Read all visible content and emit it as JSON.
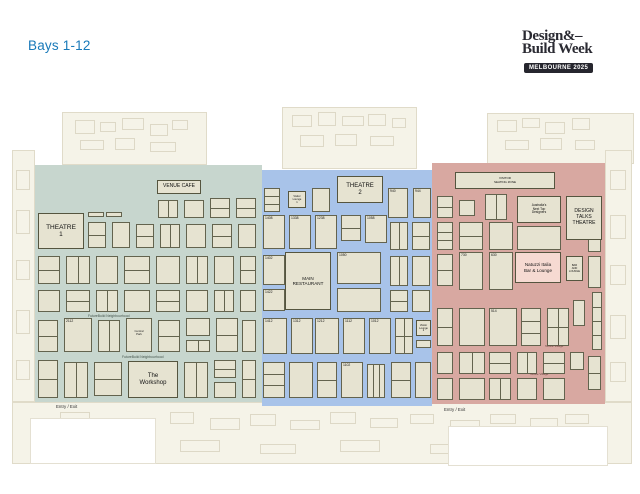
{
  "page": {
    "title": "Bays 1-12",
    "title_color": "#1879b9"
  },
  "logo": {
    "line1": "Design&–",
    "line2": "Build Week",
    "badge": "MELBOURNE 2025"
  },
  "colors": {
    "zone_green": "#c7d6ce",
    "zone_blue": "#a8c3e9",
    "zone_red": "#d8a8a1",
    "booth_fill": "#e6e3d1",
    "booth_border": "#63634e",
    "natuzzi_fill": "#f6dad2",
    "floor_cream": "#f5f3e8",
    "title_blue": "#1879b9"
  },
  "zones": [
    {
      "id": "zone-green",
      "x": 35,
      "y": 165,
      "w": 227,
      "h": 237,
      "color": "#c7d6ce"
    },
    {
      "id": "zone-blue",
      "x": 262,
      "y": 170,
      "w": 170,
      "h": 236,
      "color": "#a8c3e9"
    },
    {
      "id": "zone-red",
      "x": 432,
      "y": 163,
      "w": 173,
      "h": 241,
      "color": "#d8a8a1"
    }
  ],
  "venues": [
    {
      "id": "theatre-1",
      "x": 38,
      "y": 213,
      "w": 46,
      "h": 36,
      "label": "THEATRE\n1",
      "fs": 6.5
    },
    {
      "id": "venue-cafe",
      "x": 157,
      "y": 180,
      "w": 44,
      "h": 14,
      "label": "VENUE CAFE",
      "fs": 5
    },
    {
      "id": "theatre-2",
      "x": 337,
      "y": 176,
      "w": 46,
      "h": 27,
      "label": "THEATRE\n2",
      "fs": 6
    },
    {
      "id": "main-restaurant",
      "x": 285,
      "y": 252,
      "w": 46,
      "h": 58,
      "label": "MAIN\nRESTAURANT",
      "fs": 4.6
    },
    {
      "id": "the-workshop",
      "x": 128,
      "y": 361,
      "w": 50,
      "h": 37,
      "label": "The\nWorkshop",
      "fs": 6
    },
    {
      "id": "visitor-seating-zone",
      "x": 455,
      "y": 172,
      "w": 100,
      "h": 17,
      "label": "VISITOR\nSEATING ZONE",
      "fs": 3
    },
    {
      "id": "next-top-designers",
      "x": 517,
      "y": 196,
      "w": 44,
      "h": 27,
      "label": "Australia's\nNext Top\nDesigners",
      "fs": 3.2
    },
    {
      "id": "design-talks-theatre",
      "x": 566,
      "y": 196,
      "w": 36,
      "h": 44,
      "label": "DESIGN\nTALKS\nTHEATRE",
      "fs": 5
    },
    {
      "id": "natuzzi-bar-lounge",
      "x": 515,
      "y": 252,
      "w": 46,
      "h": 31,
      "label": "Natuzzi Italia\nBar & Lounge",
      "fs": 4.6,
      "fill": "#f6dad2"
    },
    {
      "id": "bar-and-lounge",
      "x": 566,
      "y": 256,
      "w": 17,
      "h": 25,
      "label": "BAR\nAND\nLOUNGE",
      "fs": 2.6
    },
    {
      "id": "visitor-lounge-1",
      "x": 288,
      "y": 191,
      "w": 18,
      "h": 17,
      "label": "Visitor\nLounge\n1",
      "fs": 2.6
    },
    {
      "id": "visitor-lounge-2",
      "x": 416,
      "y": 320,
      "w": 15,
      "h": 16,
      "label": "Visitor\nLounge\n2",
      "fs": 2.6
    }
  ],
  "small_labels": [
    {
      "id": "futurebuild-label-1",
      "text": "FutureBuild Neighbourhood",
      "x": 88,
      "y": 314,
      "fs": 3.4,
      "color": "#44544c"
    },
    {
      "id": "futurebuild-label-2",
      "text": "FutureBuild Neighbourhood",
      "x": 122,
      "y": 355,
      "fs": 3.4,
      "color": "#44544c"
    },
    {
      "id": "textile-village-label-1",
      "text": "Textile Village",
      "x": 545,
      "y": 344,
      "fs": 3,
      "color": "#6a4540"
    },
    {
      "id": "textile-village-label-2",
      "text": "Textile Village",
      "x": 530,
      "y": 372,
      "fs": 3,
      "color": "#6a4540"
    },
    {
      "id": "entry-exit-label-left",
      "text": "Entry / Exit",
      "x": 56,
      "y": 404,
      "fs": 4.4,
      "color": "#333333"
    },
    {
      "id": "entry-exit-label-right",
      "text": "Entry / Exit",
      "x": 444,
      "y": 407,
      "fs": 4.4,
      "color": "#333333"
    }
  ],
  "booths": {
    "green": [
      {
        "x": 88,
        "y": 212,
        "w": 16,
        "h": 5
      },
      {
        "x": 106,
        "y": 212,
        "w": 16,
        "h": 5
      },
      {
        "x": 158,
        "y": 200,
        "w": 20,
        "h": 18,
        "d": "v"
      },
      {
        "x": 184,
        "y": 200,
        "w": 20,
        "h": 18
      },
      {
        "x": 210,
        "y": 198,
        "w": 20,
        "h": 20,
        "d": "h"
      },
      {
        "x": 236,
        "y": 198,
        "w": 20,
        "h": 20,
        "d": "h"
      },
      {
        "x": 88,
        "y": 222,
        "w": 18,
        "h": 26,
        "d": "h"
      },
      {
        "x": 112,
        "y": 222,
        "w": 18,
        "h": 26
      },
      {
        "x": 136,
        "y": 224,
        "w": 18,
        "h": 24,
        "d": "h"
      },
      {
        "x": 160,
        "y": 224,
        "w": 20,
        "h": 24,
        "d": "v"
      },
      {
        "x": 186,
        "y": 224,
        "w": 20,
        "h": 24
      },
      {
        "x": 212,
        "y": 224,
        "w": 20,
        "h": 24,
        "d": "h"
      },
      {
        "x": 238,
        "y": 224,
        "w": 18,
        "h": 24
      },
      {
        "x": 38,
        "y": 256,
        "w": 22,
        "h": 28,
        "d": "h"
      },
      {
        "x": 66,
        "y": 256,
        "w": 24,
        "h": 28,
        "d": "v"
      },
      {
        "x": 96,
        "y": 256,
        "w": 22,
        "h": 28
      },
      {
        "x": 124,
        "y": 256,
        "w": 26,
        "h": 28,
        "d": "h"
      },
      {
        "x": 156,
        "y": 256,
        "w": 24,
        "h": 28
      },
      {
        "x": 186,
        "y": 256,
        "w": 22,
        "h": 28,
        "d": "v"
      },
      {
        "x": 214,
        "y": 256,
        "w": 20,
        "h": 28
      },
      {
        "x": 240,
        "y": 256,
        "w": 16,
        "h": 28,
        "d": "h"
      },
      {
        "x": 38,
        "y": 290,
        "w": 22,
        "h": 22
      },
      {
        "x": 66,
        "y": 290,
        "w": 24,
        "h": 22,
        "d": "h"
      },
      {
        "x": 96,
        "y": 290,
        "w": 22,
        "h": 22,
        "d": "v"
      },
      {
        "x": 124,
        "y": 290,
        "w": 26,
        "h": 22
      },
      {
        "x": 156,
        "y": 290,
        "w": 24,
        "h": 22,
        "d": "h"
      },
      {
        "x": 186,
        "y": 290,
        "w": 22,
        "h": 22
      },
      {
        "x": 214,
        "y": 290,
        "w": 20,
        "h": 22,
        "d": "v"
      },
      {
        "x": 240,
        "y": 290,
        "w": 16,
        "h": 22
      },
      {
        "x": 38,
        "y": 320,
        "w": 20,
        "h": 32,
        "d": "h"
      },
      {
        "x": 64,
        "y": 318,
        "w": 28,
        "h": 34,
        "n": "2112"
      },
      {
        "x": 98,
        "y": 320,
        "w": 22,
        "h": 32,
        "d": "v"
      },
      {
        "x": 126,
        "y": 318,
        "w": 26,
        "h": 34,
        "t": "Central\nPark"
      },
      {
        "x": 158,
        "y": 320,
        "w": 22,
        "h": 32,
        "d": "h"
      },
      {
        "x": 186,
        "y": 318,
        "w": 24,
        "h": 18
      },
      {
        "x": 186,
        "y": 340,
        "w": 24,
        "h": 12,
        "d": "v"
      },
      {
        "x": 216,
        "y": 318,
        "w": 22,
        "h": 34,
        "d": "h"
      },
      {
        "x": 242,
        "y": 320,
        "w": 14,
        "h": 32
      },
      {
        "x": 38,
        "y": 360,
        "w": 20,
        "h": 38,
        "d": "h"
      },
      {
        "x": 64,
        "y": 362,
        "w": 24,
        "h": 36,
        "d": "v"
      },
      {
        "x": 94,
        "y": 362,
        "w": 28,
        "h": 34,
        "d": "h"
      },
      {
        "x": 184,
        "y": 362,
        "w": 24,
        "h": 36,
        "d": "v"
      },
      {
        "x": 214,
        "y": 360,
        "w": 22,
        "h": 18,
        "d": "h"
      },
      {
        "x": 214,
        "y": 382,
        "w": 22,
        "h": 16
      },
      {
        "x": 242,
        "y": 360,
        "w": 14,
        "h": 38,
        "d": "h"
      }
    ],
    "blue": [
      {
        "x": 264,
        "y": 188,
        "w": 16,
        "h": 24,
        "d": "h2"
      },
      {
        "x": 312,
        "y": 188,
        "w": 18,
        "h": 24
      },
      {
        "x": 388,
        "y": 188,
        "w": 20,
        "h": 30,
        "n": "940"
      },
      {
        "x": 413,
        "y": 188,
        "w": 18,
        "h": 30,
        "n": "944"
      },
      {
        "x": 263,
        "y": 215,
        "w": 22,
        "h": 34,
        "n": "1408"
      },
      {
        "x": 289,
        "y": 215,
        "w": 22,
        "h": 34,
        "n": "1338"
      },
      {
        "x": 315,
        "y": 215,
        "w": 22,
        "h": 34,
        "n": "1238"
      },
      {
        "x": 341,
        "y": 215,
        "w": 20,
        "h": 26,
        "d": "h"
      },
      {
        "x": 365,
        "y": 215,
        "w": 22,
        "h": 28,
        "n": "1058"
      },
      {
        "x": 390,
        "y": 222,
        "w": 18,
        "h": 28,
        "d": "v"
      },
      {
        "x": 412,
        "y": 222,
        "w": 18,
        "h": 28,
        "d": "h"
      },
      {
        "x": 263,
        "y": 255,
        "w": 22,
        "h": 30,
        "n": "1402"
      },
      {
        "x": 337,
        "y": 252,
        "w": 44,
        "h": 32,
        "n": "1050"
      },
      {
        "x": 390,
        "y": 256,
        "w": 18,
        "h": 30,
        "d": "v"
      },
      {
        "x": 412,
        "y": 256,
        "w": 18,
        "h": 30
      },
      {
        "x": 263,
        "y": 289,
        "w": 22,
        "h": 22,
        "n": "1422"
      },
      {
        "x": 337,
        "y": 288,
        "w": 44,
        "h": 24
      },
      {
        "x": 390,
        "y": 290,
        "w": 18,
        "h": 22,
        "d": "h"
      },
      {
        "x": 412,
        "y": 290,
        "w": 18,
        "h": 22
      },
      {
        "x": 263,
        "y": 318,
        "w": 24,
        "h": 36,
        "n": "1412"
      },
      {
        "x": 291,
        "y": 318,
        "w": 22,
        "h": 36,
        "n": "1312"
      },
      {
        "x": 315,
        "y": 318,
        "w": 24,
        "h": 36,
        "n": "1212"
      },
      {
        "x": 343,
        "y": 318,
        "w": 22,
        "h": 36,
        "n": "1112"
      },
      {
        "x": 369,
        "y": 318,
        "w": 22,
        "h": 36,
        "n": "1012"
      },
      {
        "x": 395,
        "y": 318,
        "w": 18,
        "h": 36,
        "d": "grid"
      },
      {
        "x": 416,
        "y": 340,
        "w": 15,
        "h": 8
      },
      {
        "x": 263,
        "y": 362,
        "w": 22,
        "h": 36,
        "d": "h2"
      },
      {
        "x": 289,
        "y": 362,
        "w": 24,
        "h": 36
      },
      {
        "x": 317,
        "y": 362,
        "w": 20,
        "h": 36,
        "d": "h"
      },
      {
        "x": 341,
        "y": 362,
        "w": 22,
        "h": 36,
        "n": "1102"
      },
      {
        "x": 367,
        "y": 364,
        "w": 18,
        "h": 34,
        "d": "v2"
      },
      {
        "x": 391,
        "y": 362,
        "w": 20,
        "h": 36,
        "d": "h"
      },
      {
        "x": 415,
        "y": 362,
        "w": 16,
        "h": 36
      }
    ],
    "red": [
      {
        "x": 437,
        "y": 196,
        "w": 16,
        "h": 22,
        "d": "h"
      },
      {
        "x": 459,
        "y": 200,
        "w": 16,
        "h": 16
      },
      {
        "x": 485,
        "y": 194,
        "w": 22,
        "h": 26,
        "d": "v"
      },
      {
        "x": 437,
        "y": 222,
        "w": 16,
        "h": 28,
        "d": "h2"
      },
      {
        "x": 459,
        "y": 222,
        "w": 24,
        "h": 28,
        "d": "h"
      },
      {
        "x": 489,
        "y": 222,
        "w": 24,
        "h": 28
      },
      {
        "x": 517,
        "y": 226,
        "w": 44,
        "h": 24
      },
      {
        "x": 437,
        "y": 254,
        "w": 16,
        "h": 32,
        "d": "h"
      },
      {
        "x": 459,
        "y": 252,
        "w": 24,
        "h": 38,
        "n": "730"
      },
      {
        "x": 489,
        "y": 252,
        "w": 24,
        "h": 38,
        "n": "630"
      },
      {
        "x": 588,
        "y": 224,
        "w": 13,
        "h": 28,
        "d": "h"
      },
      {
        "x": 588,
        "y": 256,
        "w": 13,
        "h": 32
      },
      {
        "x": 437,
        "y": 308,
        "w": 16,
        "h": 38,
        "d": "h"
      },
      {
        "x": 459,
        "y": 308,
        "w": 26,
        "h": 38
      },
      {
        "x": 489,
        "y": 308,
        "w": 28,
        "h": 38,
        "n": "514"
      },
      {
        "x": 521,
        "y": 308,
        "w": 20,
        "h": 38,
        "d": "h2"
      },
      {
        "x": 547,
        "y": 308,
        "w": 22,
        "h": 38,
        "d": "grid"
      },
      {
        "x": 573,
        "y": 300,
        "w": 12,
        "h": 26
      },
      {
        "x": 592,
        "y": 292,
        "w": 10,
        "h": 58,
        "d": "h3"
      },
      {
        "x": 437,
        "y": 352,
        "w": 16,
        "h": 22
      },
      {
        "x": 459,
        "y": 352,
        "w": 26,
        "h": 22,
        "d": "v"
      },
      {
        "x": 489,
        "y": 352,
        "w": 22,
        "h": 22,
        "d": "h"
      },
      {
        "x": 517,
        "y": 352,
        "w": 20,
        "h": 22,
        "d": "v"
      },
      {
        "x": 543,
        "y": 352,
        "w": 22,
        "h": 22,
        "d": "h"
      },
      {
        "x": 570,
        "y": 352,
        "w": 14,
        "h": 18
      },
      {
        "x": 437,
        "y": 378,
        "w": 16,
        "h": 22
      },
      {
        "x": 459,
        "y": 378,
        "w": 26,
        "h": 22
      },
      {
        "x": 489,
        "y": 378,
        "w": 22,
        "h": 22,
        "d": "v"
      },
      {
        "x": 517,
        "y": 378,
        "w": 20,
        "h": 22
      },
      {
        "x": 543,
        "y": 378,
        "w": 22,
        "h": 22
      },
      {
        "x": 588,
        "y": 356,
        "w": 13,
        "h": 34,
        "d": "h"
      }
    ]
  }
}
